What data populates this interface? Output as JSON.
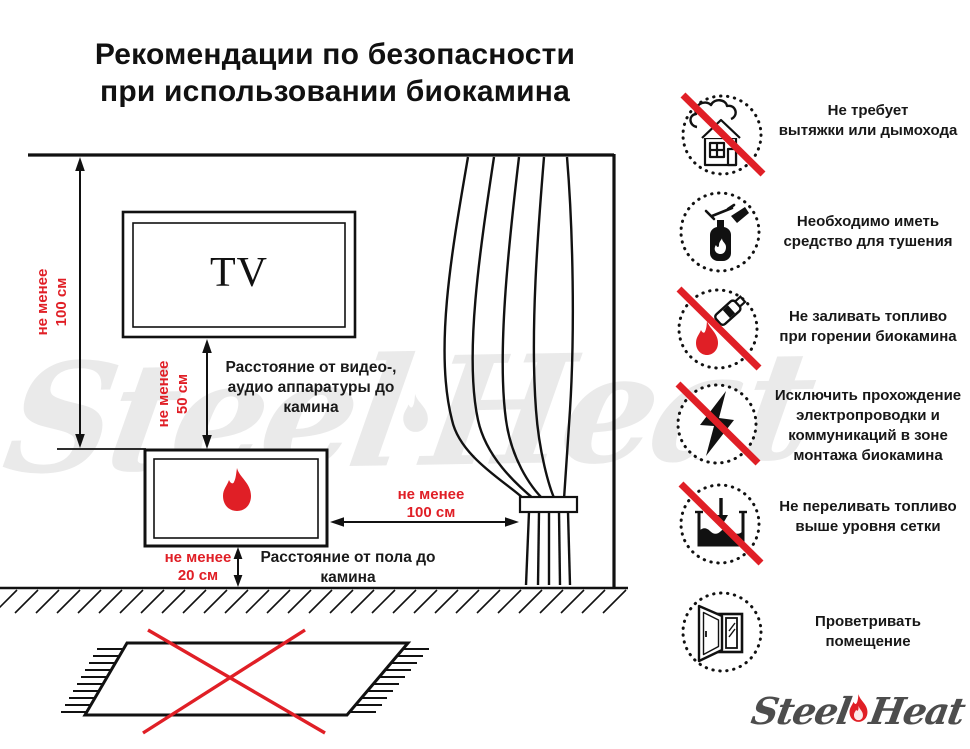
{
  "title": "Рекомендации по безопасности\nпри использовании биокамина",
  "colors": {
    "accent_red": "#E01F26",
    "line_black": "#111111",
    "logo_gray": "#4D4D4D",
    "watermark_gray": "rgba(0,0,0,0.08)"
  },
  "diagram": {
    "tv_label": "TV",
    "labels": {
      "wall_distance": "не менее\n100 см",
      "av_distance_value": "не менее\n50 см",
      "av_distance_caption": "Расстояние от видео-,\nаудио аппаратуры до\nкамина",
      "curtain_distance": "не менее\n100 см",
      "floor_distance_value": "не менее\n20 см",
      "floor_distance_caption": "Расстояние от пола до\nкамина"
    },
    "icons": [
      "tv-box",
      "fireplace-flame-icon",
      "curtain",
      "crossed-carpet",
      "wall",
      "floor"
    ]
  },
  "recommendations": [
    {
      "icon": "no-chimney-icon",
      "prohibited": true,
      "text": "Не требует\nвытяжки или дымохода"
    },
    {
      "icon": "extinguisher-icon",
      "prohibited": false,
      "text": "Необходимо иметь\nсредство для тушения"
    },
    {
      "icon": "no-refueling-while-burning-icon",
      "prohibited": true,
      "text": "Не заливать топливо\nпри горении биокамина"
    },
    {
      "icon": "no-electrical-wiring-icon",
      "prohibited": true,
      "text": "Исключить прохождение\nэлектропроводки и\nкоммуникаций в зоне\nмонтажа биокамина"
    },
    {
      "icon": "no-overfill-icon",
      "prohibited": true,
      "text": "Не переливать топливо\nвыше уровня сетки"
    },
    {
      "icon": "ventilate-icon",
      "prohibited": false,
      "text": "Проветривать\nпомещение"
    }
  ],
  "logo": {
    "steel": "Steel",
    "heat": "Heat"
  },
  "watermark": {
    "steel": "Steel",
    "heat": "Heat"
  }
}
